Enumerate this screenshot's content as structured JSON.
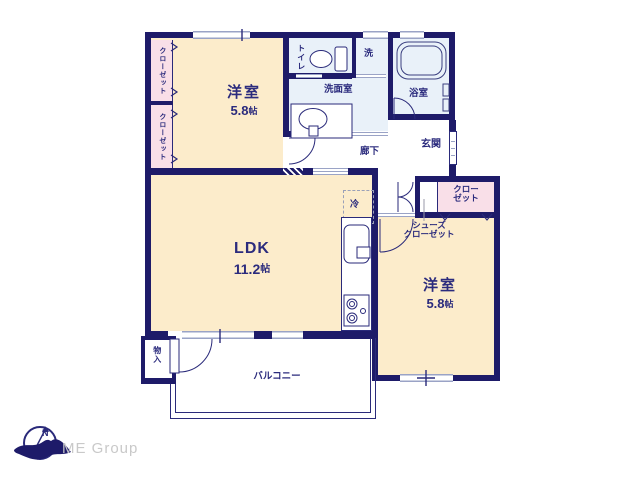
{
  "colors": {
    "wall": "#1e1b69",
    "text": "#2b2b7d",
    "room_cream": "#fceccb",
    "closet_pink": "#f9dfe8",
    "wet_area_blue": "#e9f1f9",
    "window_line": "#9aa3c6",
    "logo_text_gray": "#c9c9c9"
  },
  "rooms": {
    "bedroom_top": {
      "name": "洋室",
      "size_num": "5.8",
      "size_unit": "帖"
    },
    "bedroom_right": {
      "name": "洋室",
      "size_num": "5.8",
      "size_unit": "帖"
    },
    "ldk": {
      "name": "LDK",
      "size_num": "11.2",
      "size_unit": "帖"
    },
    "toilet": {
      "label": "トイレ"
    },
    "washroom": {
      "label": "洗面室"
    },
    "washer_space": {
      "label": "洗"
    },
    "bathroom": {
      "label": "浴室"
    },
    "entrance": {
      "label": "玄関"
    },
    "hallway": {
      "label": "廊下"
    },
    "balcony": {
      "label": "バルコニー"
    },
    "storage": {
      "label": "物入"
    },
    "refrigerator_space": {
      "label": "冷"
    },
    "closet_left_top": {
      "label": "クローゼット"
    },
    "closet_left_bottom": {
      "label": "クローゼット"
    },
    "closet_right": {
      "line1": "クロー",
      "line2": "ゼット"
    },
    "shoes_closet": {
      "line1": "シューズ",
      "line2": "クローゼット"
    }
  },
  "logo": {
    "brand": "ME Group",
    "compass_letter": "N"
  }
}
